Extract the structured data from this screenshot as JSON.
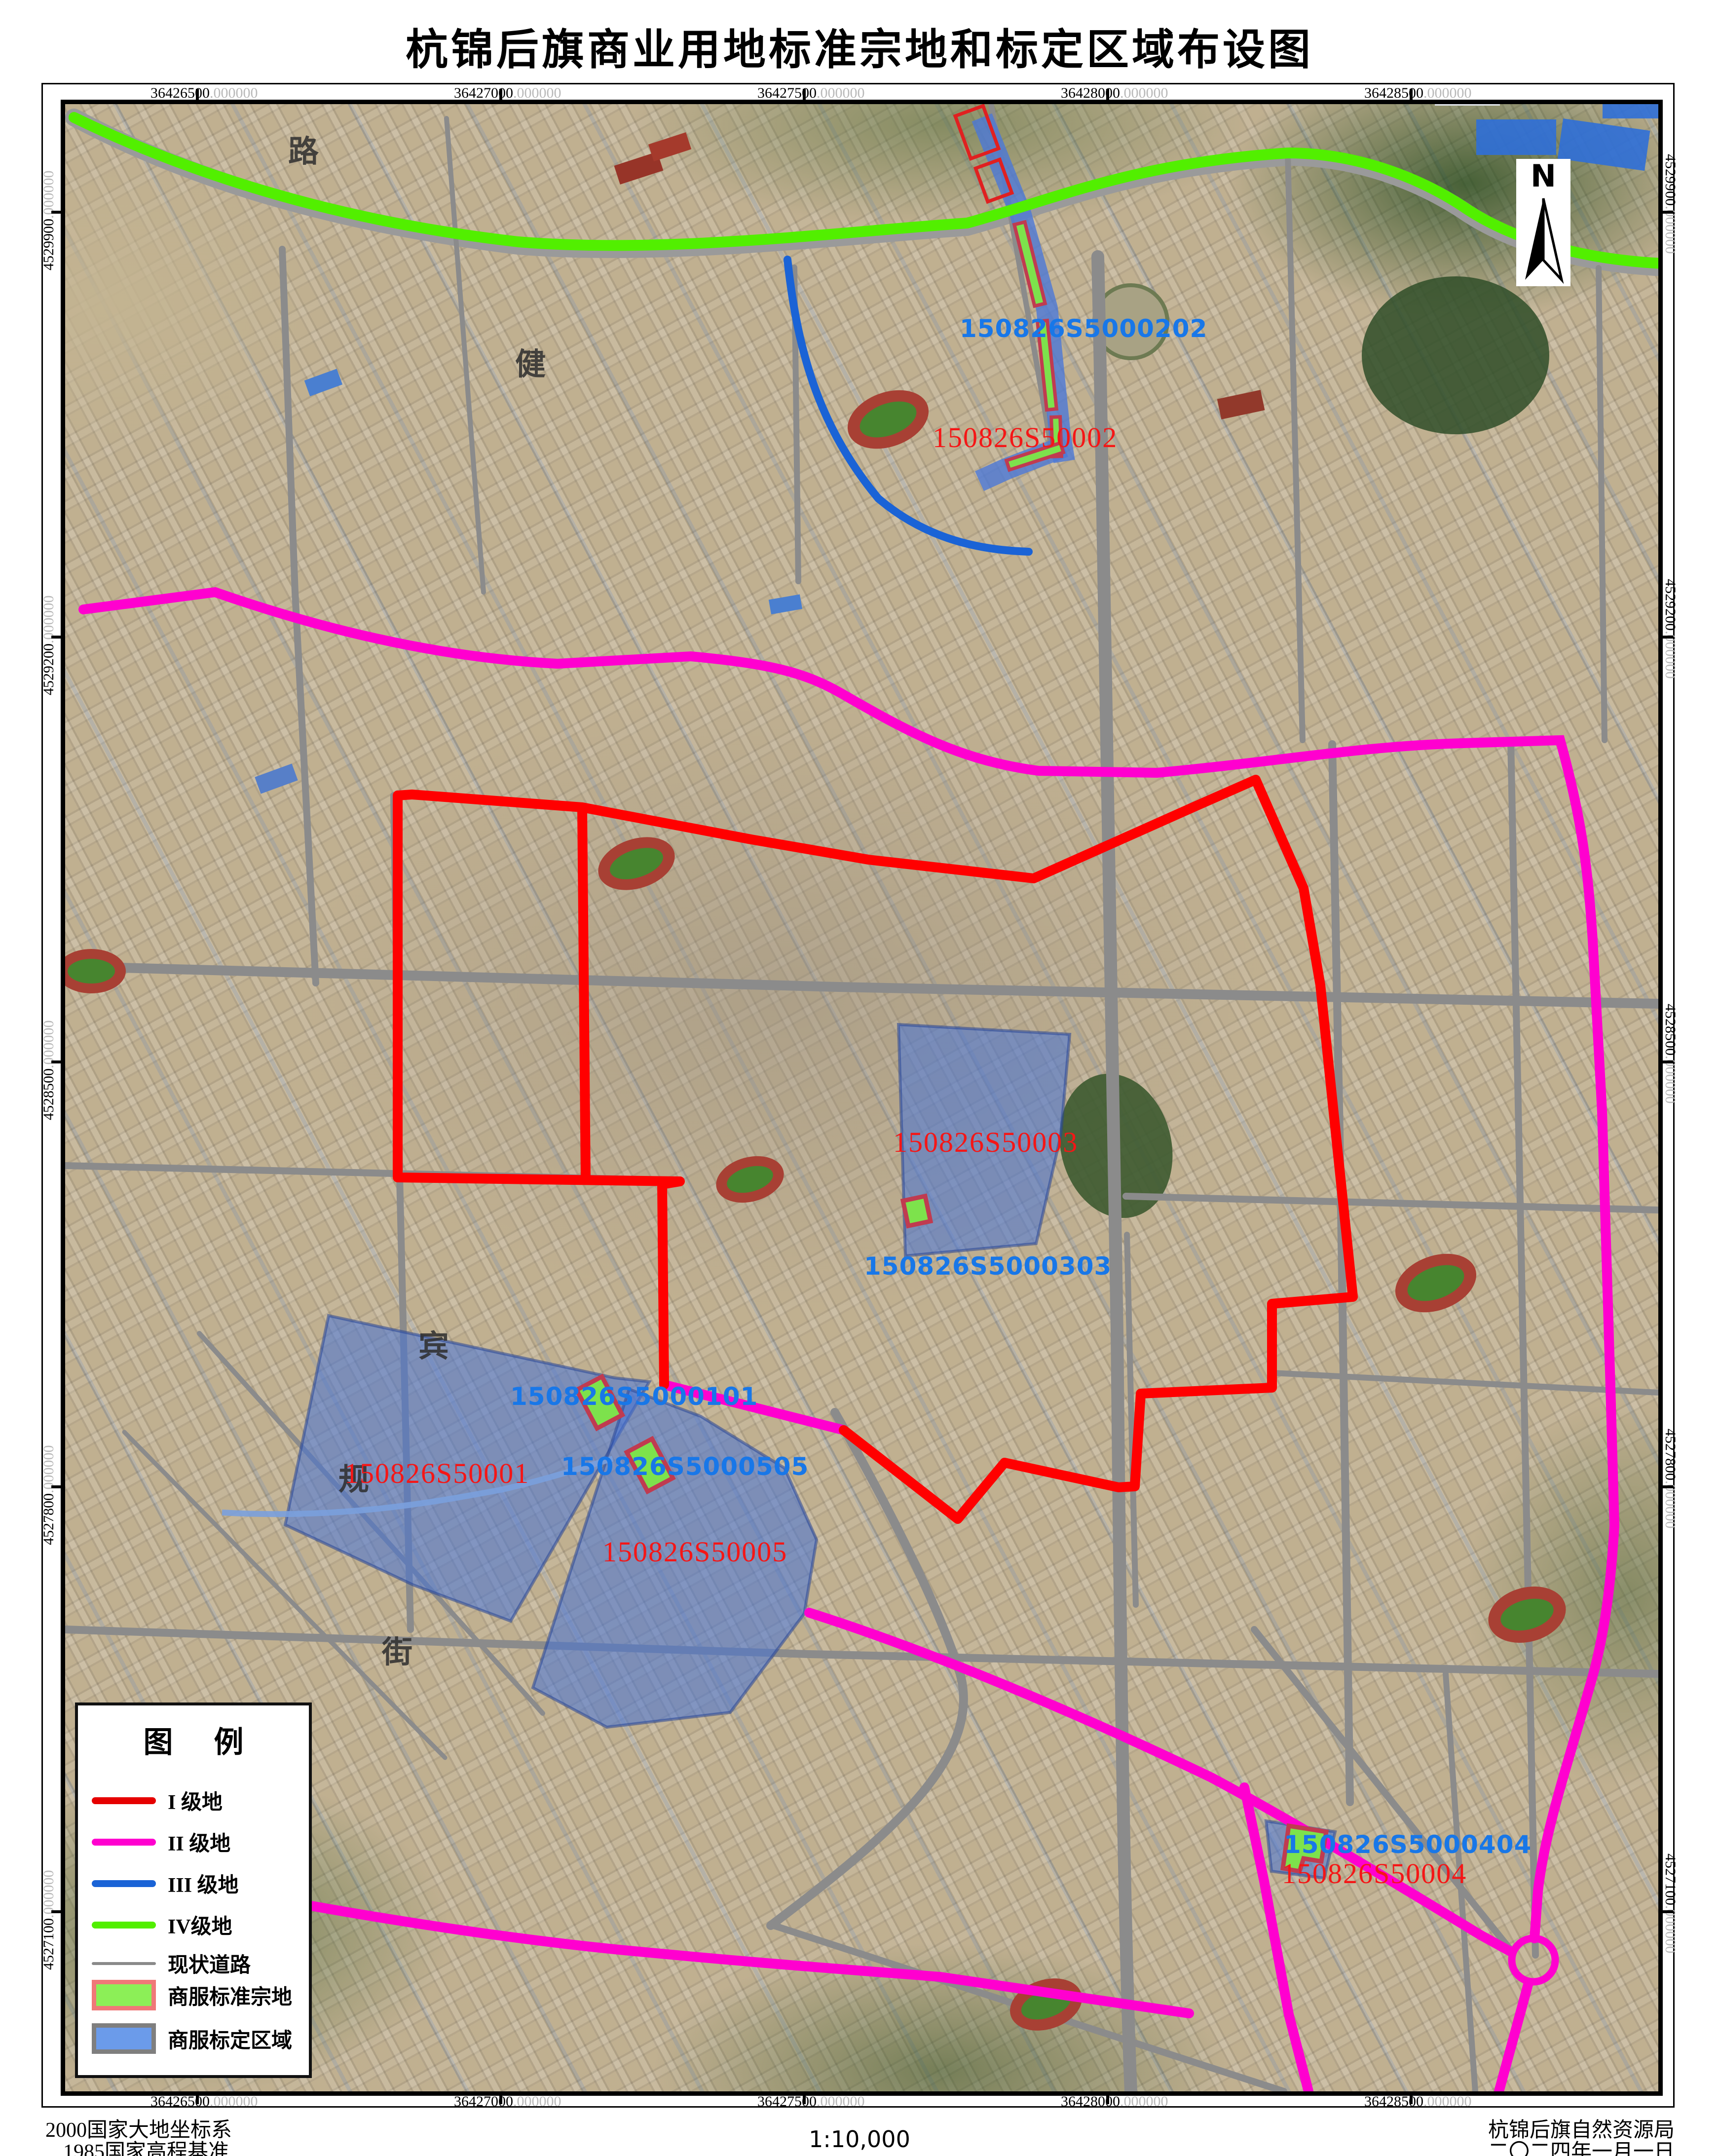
{
  "title": "杭锦后旗商业用地标准宗地和标定区域布设图",
  "north_label": "N",
  "scale_text": "1:10,000",
  "footer": {
    "datum_line1": "2000国家大地坐标系",
    "datum_line2": "1985国家高程基准",
    "agency": "杭锦后旗自然资源局",
    "date": "二〇二四年一月一日"
  },
  "legend": {
    "title": "图 例",
    "items": [
      {
        "label": "I 级地"
      },
      {
        "label": "II 级地"
      },
      {
        "label": "III 级地"
      },
      {
        "label": "IV级地"
      },
      {
        "label": "现状道路"
      },
      {
        "label": "商服标准宗地"
      },
      {
        "label": "商服标定区域"
      }
    ]
  },
  "grid": {
    "suffix": ".000000",
    "top": [
      "36426500",
      "36427000",
      "36427500",
      "36428000",
      "36428500"
    ],
    "bottom": [
      "36426500",
      "36427000",
      "36427500",
      "36428000",
      "36428500"
    ],
    "left": [
      "4529900",
      "4529200",
      "4528500",
      "4527800",
      "4527100"
    ],
    "right": [
      "4529900",
      "4529200",
      "4528500",
      "4527800",
      "4527100"
    ]
  },
  "parcel_labels": {
    "red": [
      "150826S50001",
      "150826S50002",
      "150826S50003",
      "150826S50004",
      "150826S50005"
    ],
    "blue": [
      "150826S5000101",
      "150826S5000202",
      "150826S5000303",
      "150826S5000404",
      "150826S5000505"
    ]
  },
  "street_names": [
    "路",
    "健",
    "宾",
    "规",
    "街"
  ],
  "colors": {
    "level1": "#e60000",
    "level2": "#ff00cf",
    "level3": "#1a63d6",
    "level4": "#52ef00",
    "road": "#8a8a8a",
    "parcel_fill": "#8cef57",
    "parcel_border": "#f07878",
    "region_fill": "#6b9bea",
    "region_border": "#7f7f7f"
  }
}
